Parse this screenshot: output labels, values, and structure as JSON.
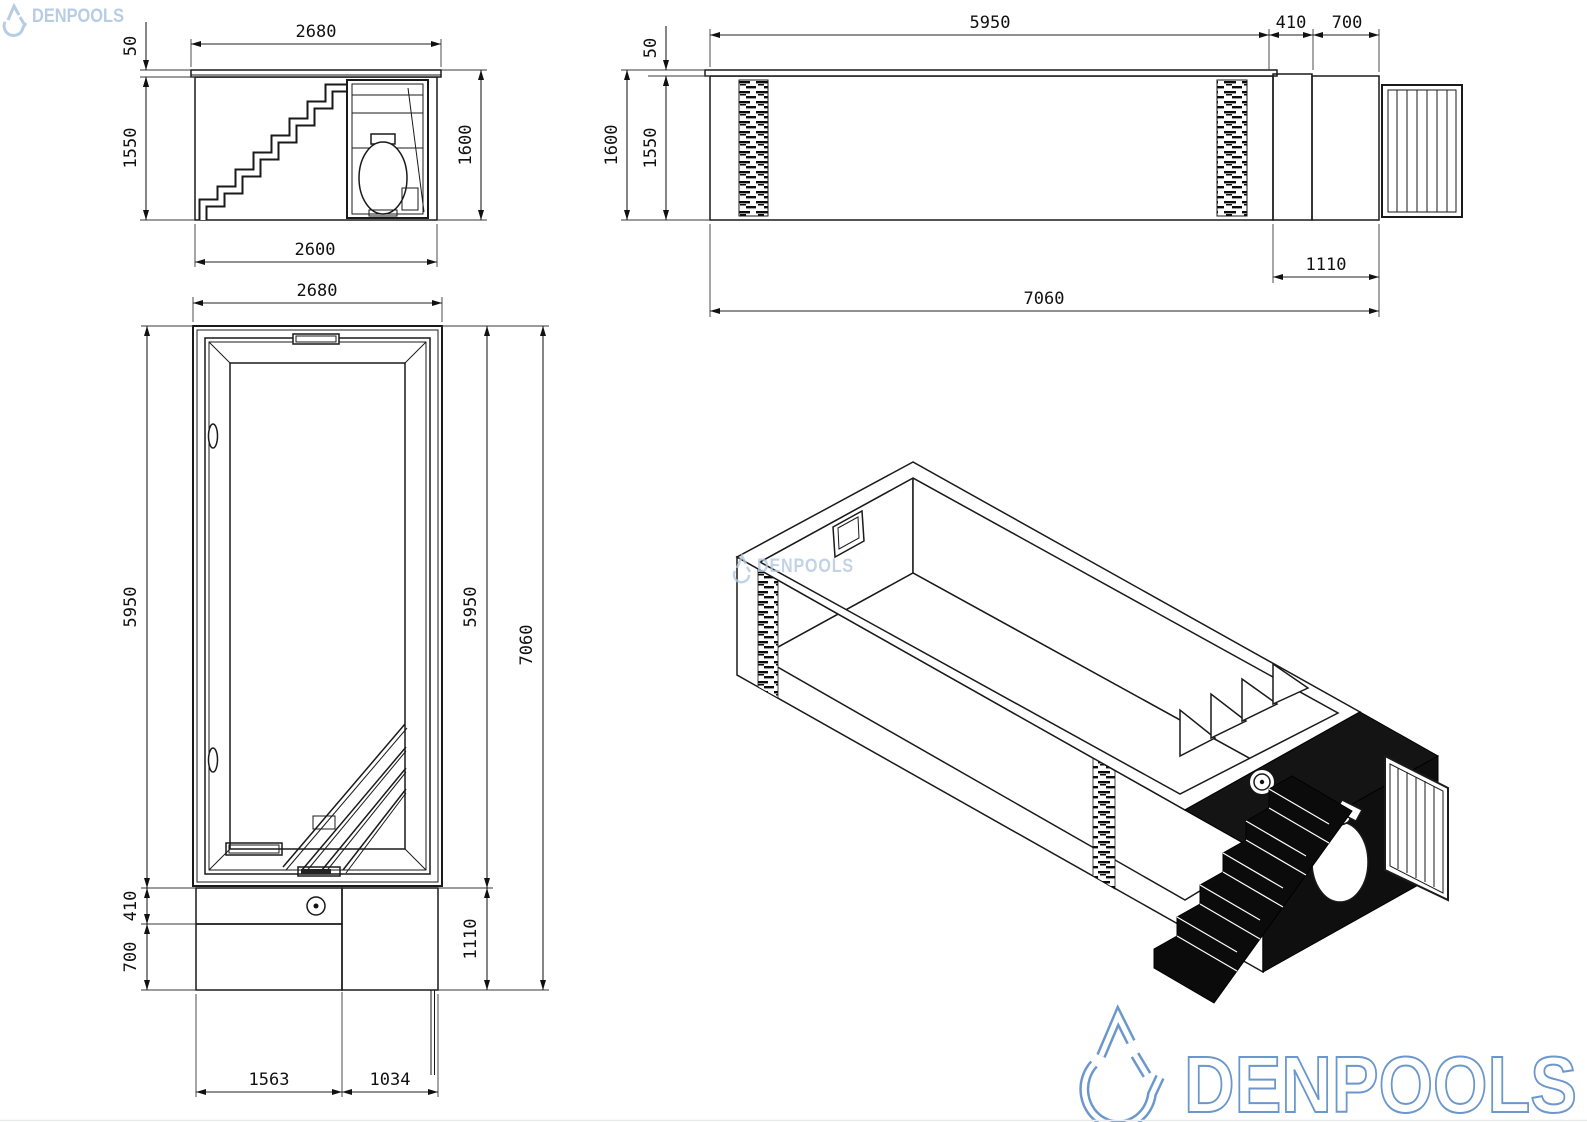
{
  "brand": {
    "name": "DENPOOLS",
    "logo_color": "#6b97cc",
    "header_logo": "DENPOOLS",
    "watermark": "DENPOOLS",
    "footer_logo": "DENPOOLS"
  },
  "views": {
    "end_elevation": {
      "dims": {
        "coping_height": "50",
        "top_width": "2680",
        "body_height": "1550",
        "overall_height": "1600",
        "base_width": "2600"
      }
    },
    "side_elevation": {
      "dims": {
        "coping_height": "50",
        "pool_length": "5950",
        "pump_bay": "410",
        "stair_bay": "700",
        "overall_height": "1600",
        "body_height": "1550",
        "deck_length": "1110",
        "overall_length": "7060"
      }
    },
    "plan": {
      "dims": {
        "top_width": "2680",
        "pool_length_left": "5950",
        "deck_upper": "410",
        "deck_lower": "700",
        "pool_length_right": "5950",
        "deck_right": "1110",
        "overall_length": "7060",
        "base_left": "1563",
        "base_right": "1034"
      }
    }
  }
}
